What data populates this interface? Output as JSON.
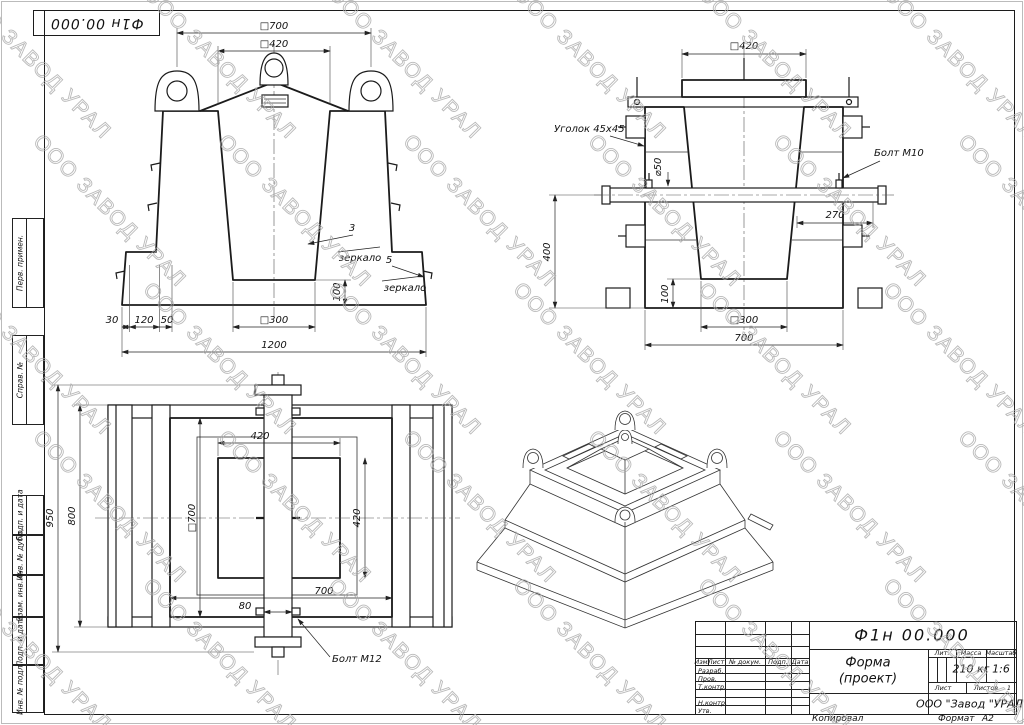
{
  "watermark": {
    "text": "ООО ЗАВОД УРАЛ"
  },
  "corner_stamp": {
    "designation": "Ф1н 00.000"
  },
  "margin": {
    "items": [
      {
        "label": "Перв. примен."
      },
      {
        "label": "Справ. №"
      },
      {
        "label": "Подп. и дата"
      },
      {
        "label": "Инв. № дубл."
      },
      {
        "label": "Взам. инв. №"
      },
      {
        "label": "Подп. и дата"
      },
      {
        "label": "Инв. № подл."
      }
    ]
  },
  "views": {
    "front": {
      "dims": {
        "top_outer": "□700",
        "top_inner": "□420",
        "base": "1200",
        "step1": "30",
        "step2": "120",
        "step3": "50",
        "cavity_bottom": "□300",
        "slab": "100"
      },
      "leaders": {
        "pos3": "3",
        "pos3_note": "зеркало",
        "pos5": "5",
        "pos5_note": "зеркало"
      }
    },
    "side": {
      "dims": {
        "top": "□420",
        "shaft_dia": "⌀50",
        "offset": "270",
        "height": "400",
        "slab": "100",
        "cavity_bottom": "□300",
        "base": "700"
      },
      "labels": {
        "angle": "Уголок 45х45",
        "bolt": "Болт М10"
      }
    },
    "plan": {
      "dims": {
        "overall": "950",
        "body": "800",
        "opening_w": "420",
        "body_sq": "□700",
        "opening_h": "420",
        "width": "700",
        "shaft": "80"
      },
      "labels": {
        "bolt": "Болт М12"
      }
    }
  },
  "title_block": {
    "designation": "Ф1н 00.000",
    "doc_name": "Форма",
    "doc_name2": "(проект)",
    "mass": "210 кг",
    "scale": "1:6",
    "sheets_value": "1",
    "company": "ООО \"Завод \"УРАЛ\"",
    "labels": {
      "izm": "Изм.",
      "list": "Лист",
      "doc": "№ докум.",
      "podp": "Подп.",
      "data": "Дата",
      "razrab": "Разраб.",
      "prov": "Пров.",
      "tkontr": "Т.контр.",
      "nkontr": "Н.контр.",
      "utv": "Утв.",
      "lit": "Лит.",
      "mass": "Масса",
      "scale": "Масштаб",
      "sheet": "Лист",
      "sheets": "Листов",
      "kopiroval": "Копировал",
      "format": "Формат",
      "format_value": "А2"
    }
  }
}
